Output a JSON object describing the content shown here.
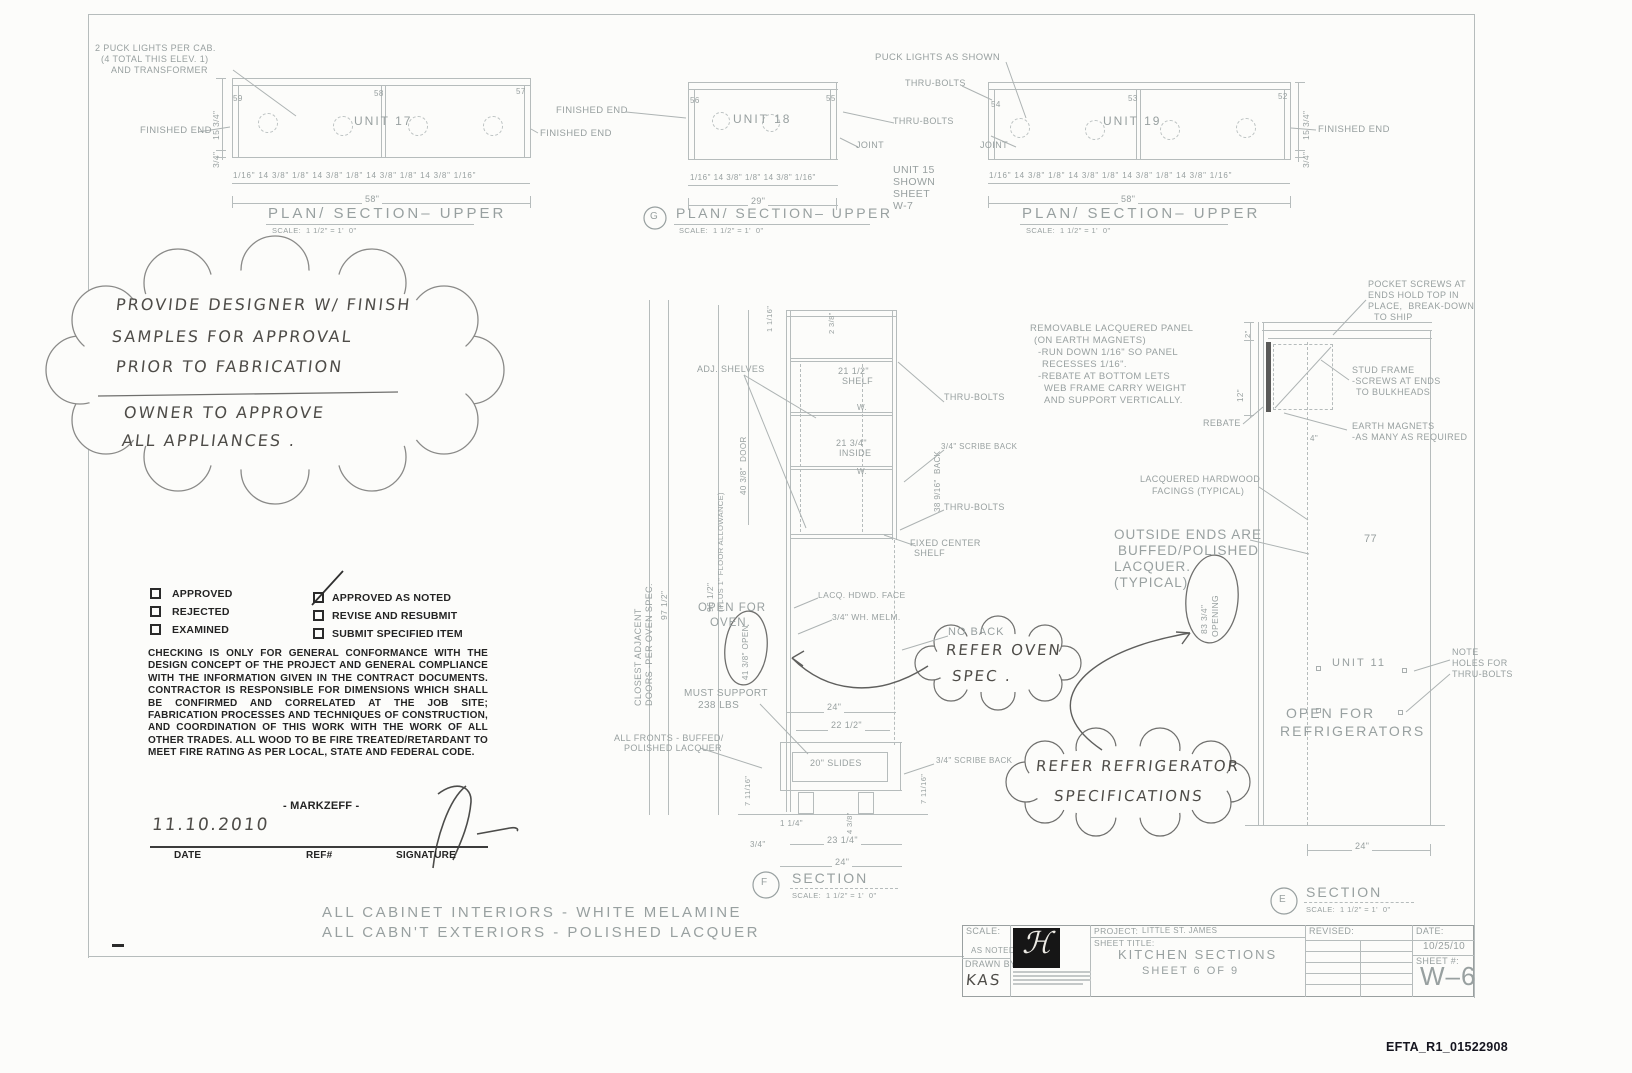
{
  "common": {
    "plan_title": "PLAN/ SECTION– UPPER",
    "plan_scale": "SCALE:  1 1/2\" = 1'  0\"",
    "section_title": "SECTION",
    "section_scale": "SCALE:  1 1/2\" = 1'  0\"",
    "finished_end": "FINISHED END",
    "thru_bolts": "THRU-BOLTS",
    "joint": "JOINT"
  },
  "plans": {
    "puck_note": [
      "2 PUCK LIGHTS PER CAB.",
      "(4 TOTAL THIS ELEV. 1)",
      "AND TRANSFORMER"
    ],
    "puck_shown": "PUCK LIGHTS AS SHOWN",
    "unit15_note": [
      "UNIT 15",
      "SHOWN",
      "SHEET",
      "W-7"
    ],
    "u17": {
      "label": "UNIT 17",
      "m1": "59",
      "m2": "58",
      "m3": "57",
      "dims": "1/16\" 14 3/8\" 1/8\" 14 3/8\" 1/8\" 14 3/8\" 1/8\" 14 3/8\" 1/16\"",
      "overall": "58\"",
      "h": "15 3/4\"",
      "t": "3/4\""
    },
    "u18": {
      "label": "UNIT 18",
      "m1": "56",
      "m2": "55",
      "dims": "1/16\" 14 3/8\" 1/8\" 14 3/8\" 1/16\"",
      "overall": "29\"",
      "mark": "G"
    },
    "u19": {
      "label": "UNIT 19",
      "m1": "54",
      "m2": "53",
      "m3": "52",
      "dims": "1/16\" 14 3/8\" 1/8\" 14 3/8\" 1/8\" 14 3/8\" 1/8\" 14 3/8\" 1/16\"",
      "overall": "58\"",
      "h": "15 3/4\"",
      "t": "3/4\""
    }
  },
  "cloud_note": {
    "l1": "PROVIDE DESIGNER W/ FINISH",
    "l2": "SAMPLES FOR APPROVAL",
    "l3": "PRIOR TO FABRICATION",
    "l4": "OWNER TO APPROVE",
    "l5": "ALL APPLIANCES ."
  },
  "stamp": {
    "c1": "APPROVED",
    "c2": "REJECTED",
    "c3": "EXAMINED",
    "c4": "APPROVED AS NOTED",
    "c5": "REVISE AND RESUBMIT",
    "c6": "SUBMIT SPECIFIED ITEM",
    "body": "CHECKING IS ONLY FOR GENERAL CONFORMANCE WITH THE DESIGN CONCEPT OF THE PROJECT AND GENERAL COMPLIANCE WITH THE INFORMATION GIVEN IN THE CONTRACT DOCUMENTS. CONTRACTOR IS RESPONSIBLE FOR DIMENSIONS WHICH SHALL BE CONFIRMED AND CORRELATED AT THE JOB SITE; FABRICATION PROCESSES AND TECHNIQUES OF CONSTRUCTION, AND COORDINATION OF THIS WORK WITH THE WORK OF ALL OTHER TRADES. ALL WOOD TO BE FIRE TREATED/RETARDANT TO MEET FIRE RATING AS PER LOCAL, STATE AND FEDERAL CODE.",
    "firm": "- MARKZEFF -",
    "date": "11.10.2010",
    "l_date": "DATE",
    "l_ref": "REF#",
    "l_sig": "SIGNATURE"
  },
  "oven": {
    "closest1": "CLOSEST ADJACENT",
    "closest2": "DOORS -PER OVEN SPEC.",
    "d97": "97 1/2\"",
    "d96": "96 1/2\"",
    "d96b": "(PLUS 1\" FLOOR ALLOWANCE)",
    "door": "40 3/8\"  DOOR",
    "d116": "1 1/16\"",
    "d238": "2 3/8\"",
    "adj": "ADJ. SHELVES",
    "shelf1": "21 1/2\"",
    "shelf2": "SHELF",
    "w": "W.",
    "inside1": "21 3/4\"",
    "inside2": "INSIDE",
    "scribe": "3/4\" SCRIBE BACK",
    "back": "38 9/16\"  BACK",
    "fixed1": "FIXED CENTER",
    "fixed2": "SHELF",
    "lacq": "LACQ. HDWD. FACE",
    "melm": "3/4\" WH. MELM.",
    "noback": "NO BACK",
    "open1": "OPEN FOR",
    "open2": "OVEN.",
    "opening": "41 3/8\" OPEN",
    "support1": "MUST SUPPORT",
    "support2": "238 LBS",
    "fronts1": "ALL FRONTS - BUFFED/",
    "fronts2": "POLISHED LACQUER",
    "d24": "24\"",
    "d2212": "22 1/2\"",
    "slides": "20\" SLIDES",
    "scribe2": "3/4\" SCRIBE BACK",
    "d71116": "7 11/16\"",
    "d438": "4 3/8\"",
    "d114": "1 1/4\"",
    "d34": "3/4\"",
    "d2314": "23 1/4\"",
    "d24b": "24\"",
    "mark": "F"
  },
  "fridge": {
    "removable": [
      "REMOVABLE LACQUERED PANEL",
      "(ON EARTH MAGNETS)",
      "-RUN DOWN 1/16\" SO PANEL",
      "RECESSES 1/16\".",
      "-REBATE AT BOTTOM LETS",
      "WEB FRAME CARRY WEIGHT",
      "AND SUPPORT VERTICALLY."
    ],
    "pocket": [
      "POCKET SCREWS AT",
      "ENDS HOLD TOP IN",
      "PLACE,  BREAK-DOWN",
      "TO SHIP"
    ],
    "stud": [
      "STUD FRAME",
      "-SCREWS AT ENDS",
      "TO BULKHEADS"
    ],
    "magnets": [
      "EARTH MAGNETS",
      "-AS MANY AS REQUIRED"
    ],
    "rebate": "REBATE",
    "d2": "2\"",
    "d12": "12\"",
    "d4": "4\"",
    "facings": [
      "LACQUERED HARDWOOD",
      "FACINGS (TYPICAL)"
    ],
    "outside": [
      "OUTSIDE ENDS ARE",
      "BUFFED/POLISHED",
      "LACQUER.",
      "(TYPICAL)"
    ],
    "d77": "77",
    "opening1": "83 3/4\"",
    "opening2": "OPENING",
    "unit": "UNIT 11",
    "holes": [
      "NOTE",
      "HOLES FOR",
      "THRU-BOLTS"
    ],
    "open1": "OPEN FOR",
    "open2": "REFRIGERATORS",
    "d24": "24\"",
    "mark": "E"
  },
  "clouds": {
    "oven1": "REFER OVEN",
    "oven2": "SPEC .",
    "fr1": "REFER REFRIGERATOR",
    "fr2": "SPECIFICATIONS"
  },
  "footer": {
    "l1": "ALL CABINET INTERIORS - WHITE MELAMINE",
    "l2": "ALL CABN'T EXTERIORS - POLISHED LACQUER"
  },
  "tb": {
    "scale_l": "SCALE:",
    "scale_v": "AS NOTED",
    "drawn_l": "DRAWN BY",
    "drawn_v": "KAS",
    "monogram": "ℋ",
    "project_l": "PROJECT:",
    "project_v": "LITTLE ST. JAMES",
    "title_l": "SHEET TITLE:",
    "title_v": "KITCHEN SECTIONS",
    "title_sub": "SHEET 6 OF 9",
    "revised_l": "REVISED:",
    "date_l": "DATE:",
    "date_v": "10/25/10",
    "sheet_l": "SHEET #:",
    "sheet_v": "W–6"
  },
  "page": {
    "watermark": "EFTA_R1_01522908"
  }
}
